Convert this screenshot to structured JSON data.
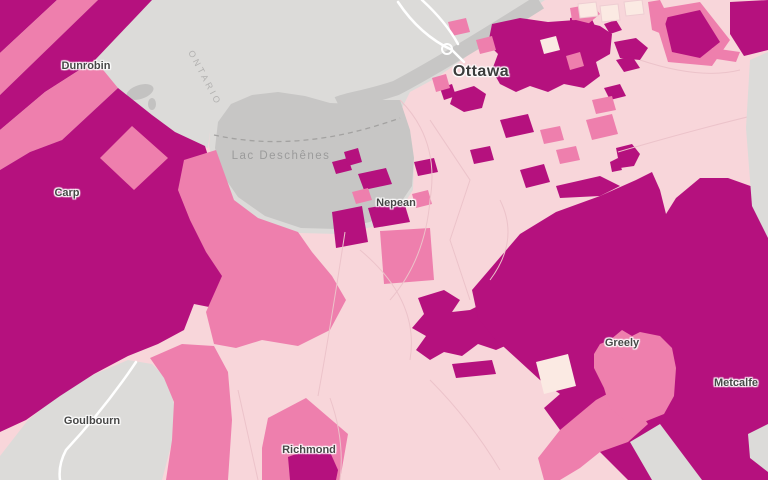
{
  "map": {
    "description": "Choropleth map of the Ottawa area with census regions shaded by intensity",
    "city_label": {
      "text": "Ottawa"
    },
    "place_labels": [
      {
        "text": "Dunrobin"
      },
      {
        "text": "Carp"
      },
      {
        "text": "Nepean"
      },
      {
        "text": "Goulbourn"
      },
      {
        "text": "Richmond"
      },
      {
        "text": "Greely"
      },
      {
        "text": "Metcalfe"
      }
    ],
    "water_label": {
      "text": "Lac Deschênes"
    },
    "province_label": {
      "text": "ONTARIO"
    },
    "palette": {
      "class_high": "#b5117e",
      "class_medium": "#ee7fad",
      "class_low": "#f8d6da",
      "class_lowest": "#fbeae3",
      "no_data_land": "#dcdbd9",
      "water": "#c7c6c5",
      "road": "#ffffff",
      "boundary_dash": "#a3a2a1"
    }
  }
}
